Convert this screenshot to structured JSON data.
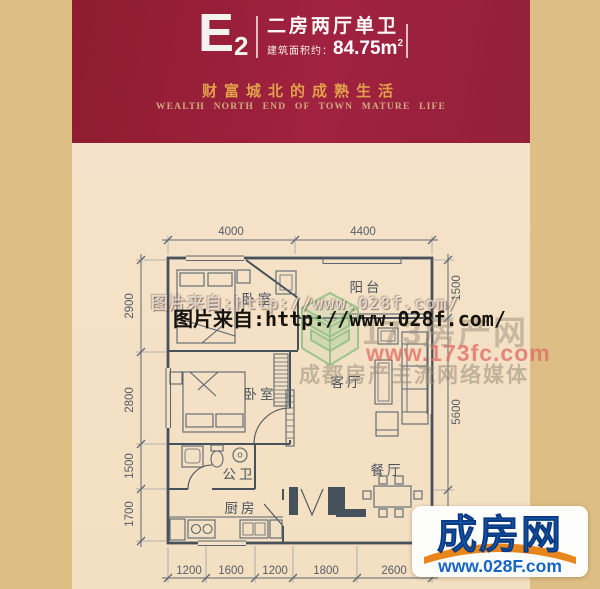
{
  "header": {
    "unit_code": "E",
    "unit_code_sub": "2",
    "unit_type": "二房两厅单卫",
    "area_label": "建筑面积约：",
    "area_value": "84.75m",
    "area_sup": "2",
    "slogan_cn": "财富城北的成熟生活",
    "slogan_en": "WEALTH NORTH END OF TOWN MATURE LIFE"
  },
  "floorplan": {
    "rooms": [
      {
        "name": "balcony",
        "label": "阳台"
      },
      {
        "name": "bedroom-1",
        "label": "卧室"
      },
      {
        "name": "living-room",
        "label": "客厅"
      },
      {
        "name": "bedroom-2",
        "label": "卧室"
      },
      {
        "name": "bathroom",
        "label": "公卫"
      },
      {
        "name": "kitchen",
        "label": "厨房"
      },
      {
        "name": "dining-room",
        "label": "餐厅"
      }
    ],
    "dimensions": {
      "top": [
        "4000",
        "4400"
      ],
      "left": [
        "2900",
        "2800",
        "1500",
        "1700"
      ],
      "right": [
        "1500",
        "5600"
      ],
      "bottom": [
        "1200",
        "1600",
        "1200",
        "1800",
        "2600"
      ]
    }
  },
  "watermarks": {
    "photo_source": "图片来自:http://www.028f.com/",
    "portal_name": "173房产网",
    "portal_url": "www.173fc.com",
    "portal_tagline": "成都房产主流网络媒体"
  },
  "footer_logo": {
    "name": "成房网",
    "url": "www.028F.com"
  },
  "colors": {
    "header_red": "#9e2139",
    "border_tan": "#ddbf85",
    "paper_cream": "#f5e1c6",
    "gold_text": "#e2a04b",
    "plan_line": "#4d5862",
    "logo_blue": "#1565c1",
    "swoosh_orange": "#e8861c",
    "watermark_green": "#8fbe84"
  }
}
